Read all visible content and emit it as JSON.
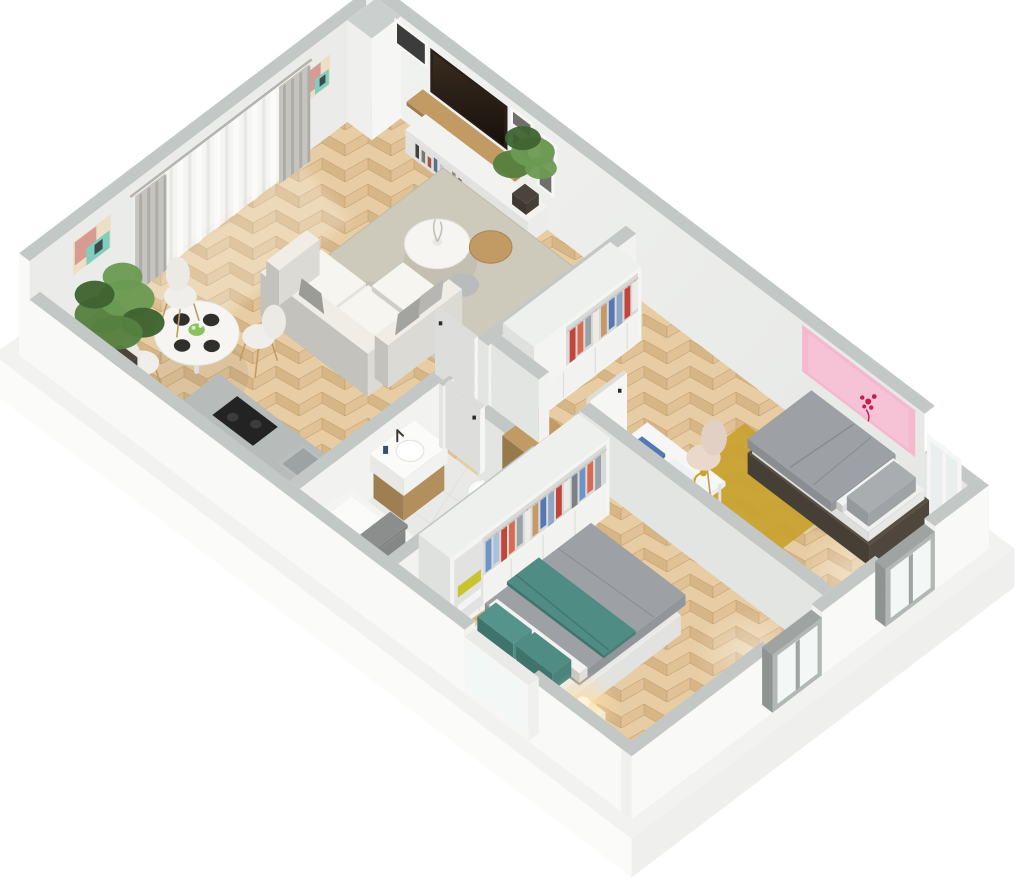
{
  "scene": {
    "type": "isometric-3d-floor-plan-render",
    "background": "#ffffff",
    "rooms": [
      {
        "name": "living-dining-room",
        "floor": "herringbone-oak",
        "furniture": [
          "corner-sofa",
          "gray-throw-pillows",
          "area-rug",
          "coffee-table",
          "side-tables",
          "flower-vase",
          "tv-wall-unit",
          "wall-mounted-tv",
          "gallery-frames",
          "bookshelf-books",
          "potted-plant-large",
          "potted-plant-small",
          "round-dining-table",
          "dining-chairs",
          "place-settings",
          "centerpiece-flowers",
          "sheer-curtains",
          "gray-drapes",
          "abstract-wall-art-large",
          "abstract-wall-art-small",
          "corner-pillar"
        ]
      },
      {
        "name": "kitchen",
        "floor": "herringbone-oak",
        "furniture": [
          "counter-run",
          "induction-cooktop",
          "steel-sink"
        ]
      },
      {
        "name": "bathroom",
        "floor": "ceramic-tile",
        "furniture": [
          "vanity-sink",
          "faucet",
          "toilet",
          "bathtub",
          "gray-towel",
          "bathroom-door"
        ]
      },
      {
        "name": "hallway",
        "floor": "herringbone-oak",
        "furniture": [
          "wood-dresser",
          "interior-doors"
        ]
      },
      {
        "name": "master-bedroom",
        "floor": "herringbone-oak",
        "furniture": [
          "double-bed",
          "teal-pillows",
          "teal-throw",
          "open-wardrobe-clothes",
          "yellow-blanket-shelf",
          "nightstand",
          "warm-table-lamp",
          "exterior-window"
        ]
      },
      {
        "name": "second-bedroom",
        "floor": "herringbone-oak",
        "furniture": [
          "single-bed",
          "gray-bedding",
          "open-wardrobe-clothes",
          "white-desk",
          "desk-books",
          "brass-desk-lamp",
          "cream-shell-chair",
          "mustard-rug",
          "pink-wall-art",
          "gray-frame-window",
          "tall-white-window"
        ]
      }
    ]
  },
  "palette": {
    "background": "#ffffff",
    "platform_top": "#f2f2f0",
    "platform_left": "#fbfbfa",
    "platform_front": "#efefed",
    "wall_top": "#c3c7c5",
    "wall_outer": "#f9f9f8",
    "wall_inner_nw": "#ebeceA",
    "wall_inner_light": "#f1f2f0",
    "wall_inner_dark": "#e5e7e5",
    "part_face_l": "#e3e5e3",
    "part_face_f": "#f2f3f1",
    "wood_a": "#e8cda4",
    "wood_b": "#d6b586",
    "wood_c": "#e0c296",
    "wood_seam": "#c8a372",
    "tile": "#e9eae8",
    "tile_line": "#dcdddb",
    "rug_living": "#cecabb",
    "rug_yellow": "#c9a233",
    "sofa": "#f2f0ea",
    "sofa_back": "#efede6",
    "pillow_gray": "#a3a3a0",
    "pillow_gray2": "#b8b6b2",
    "table_white": "#f6f5f2",
    "wood_warm": "#c29b64",
    "tv_body": "#2a2019",
    "tv_screen_hi": "#3a2c1f",
    "tv_screen_lo": "#17100b",
    "frame_mat": "#f7f7f6",
    "photo_dark": "#3c3c3c",
    "photo_mid": "#6f6f6d",
    "photo_soft": "#9a9a98",
    "art_teal": "#7fcec0",
    "art_pink": "#d79b92",
    "art_cream": "#ecdfc6",
    "art_dark": "#3f4a4a",
    "pink_art": "#f4b9cf",
    "pink_art_inner": "#f6c3d6",
    "pink_art_mark": "#c21f4e",
    "curtain_sheer": "#f5f5f3",
    "curtain_drape": "#c6c4bf",
    "curtain_rod": "#b5b3ae",
    "counter_top": "#b7bbb9",
    "counter_face": "#f2f2f0",
    "cooktop": "#232323",
    "steel": "#b9bfbf",
    "white": "#fafaf9",
    "towel": "#8b8e8d",
    "clothes": [
      "#6d93c9",
      "#a9c1de",
      "#c2443a",
      "#d96a52",
      "#9aa2a8",
      "#ecebe7",
      "#c59a68",
      "#5577b5",
      "#8fa6c5",
      "#c2443a",
      "#ecebe7",
      "#7a8288",
      "#6d93c9",
      "#d96a52",
      "#9aa2a8"
    ],
    "blanket_yellow": "#c9c32e",
    "duvet": "#9da0a4",
    "duvet_shadow": "#8a8d91",
    "sheet_white": "#f2f2f0",
    "teal": "#4f8c83",
    "teal_dark": "#3f746d",
    "bed_base_dark": "#584f44",
    "chair_cream": "#ead9cb",
    "desk_book_blue": "#5577b5",
    "brass": "#c9a227",
    "plant_g1": "#55803f",
    "plant_g2": "#6b9a52",
    "plant_g3": "#3e6330",
    "pot_dark": "#4c443c",
    "lamp_glow": "#ffdf9e",
    "plate": "#2f2f2d",
    "posy": "#8cc061",
    "door_white": "#f6f6f4",
    "handle": "#2b2b2b",
    "win_frame_gray": "#9fa4a2",
    "win_frame_white": "#f6f6f5",
    "glass": "#e9efef",
    "glass_bright": "#f3f8f7"
  }
}
